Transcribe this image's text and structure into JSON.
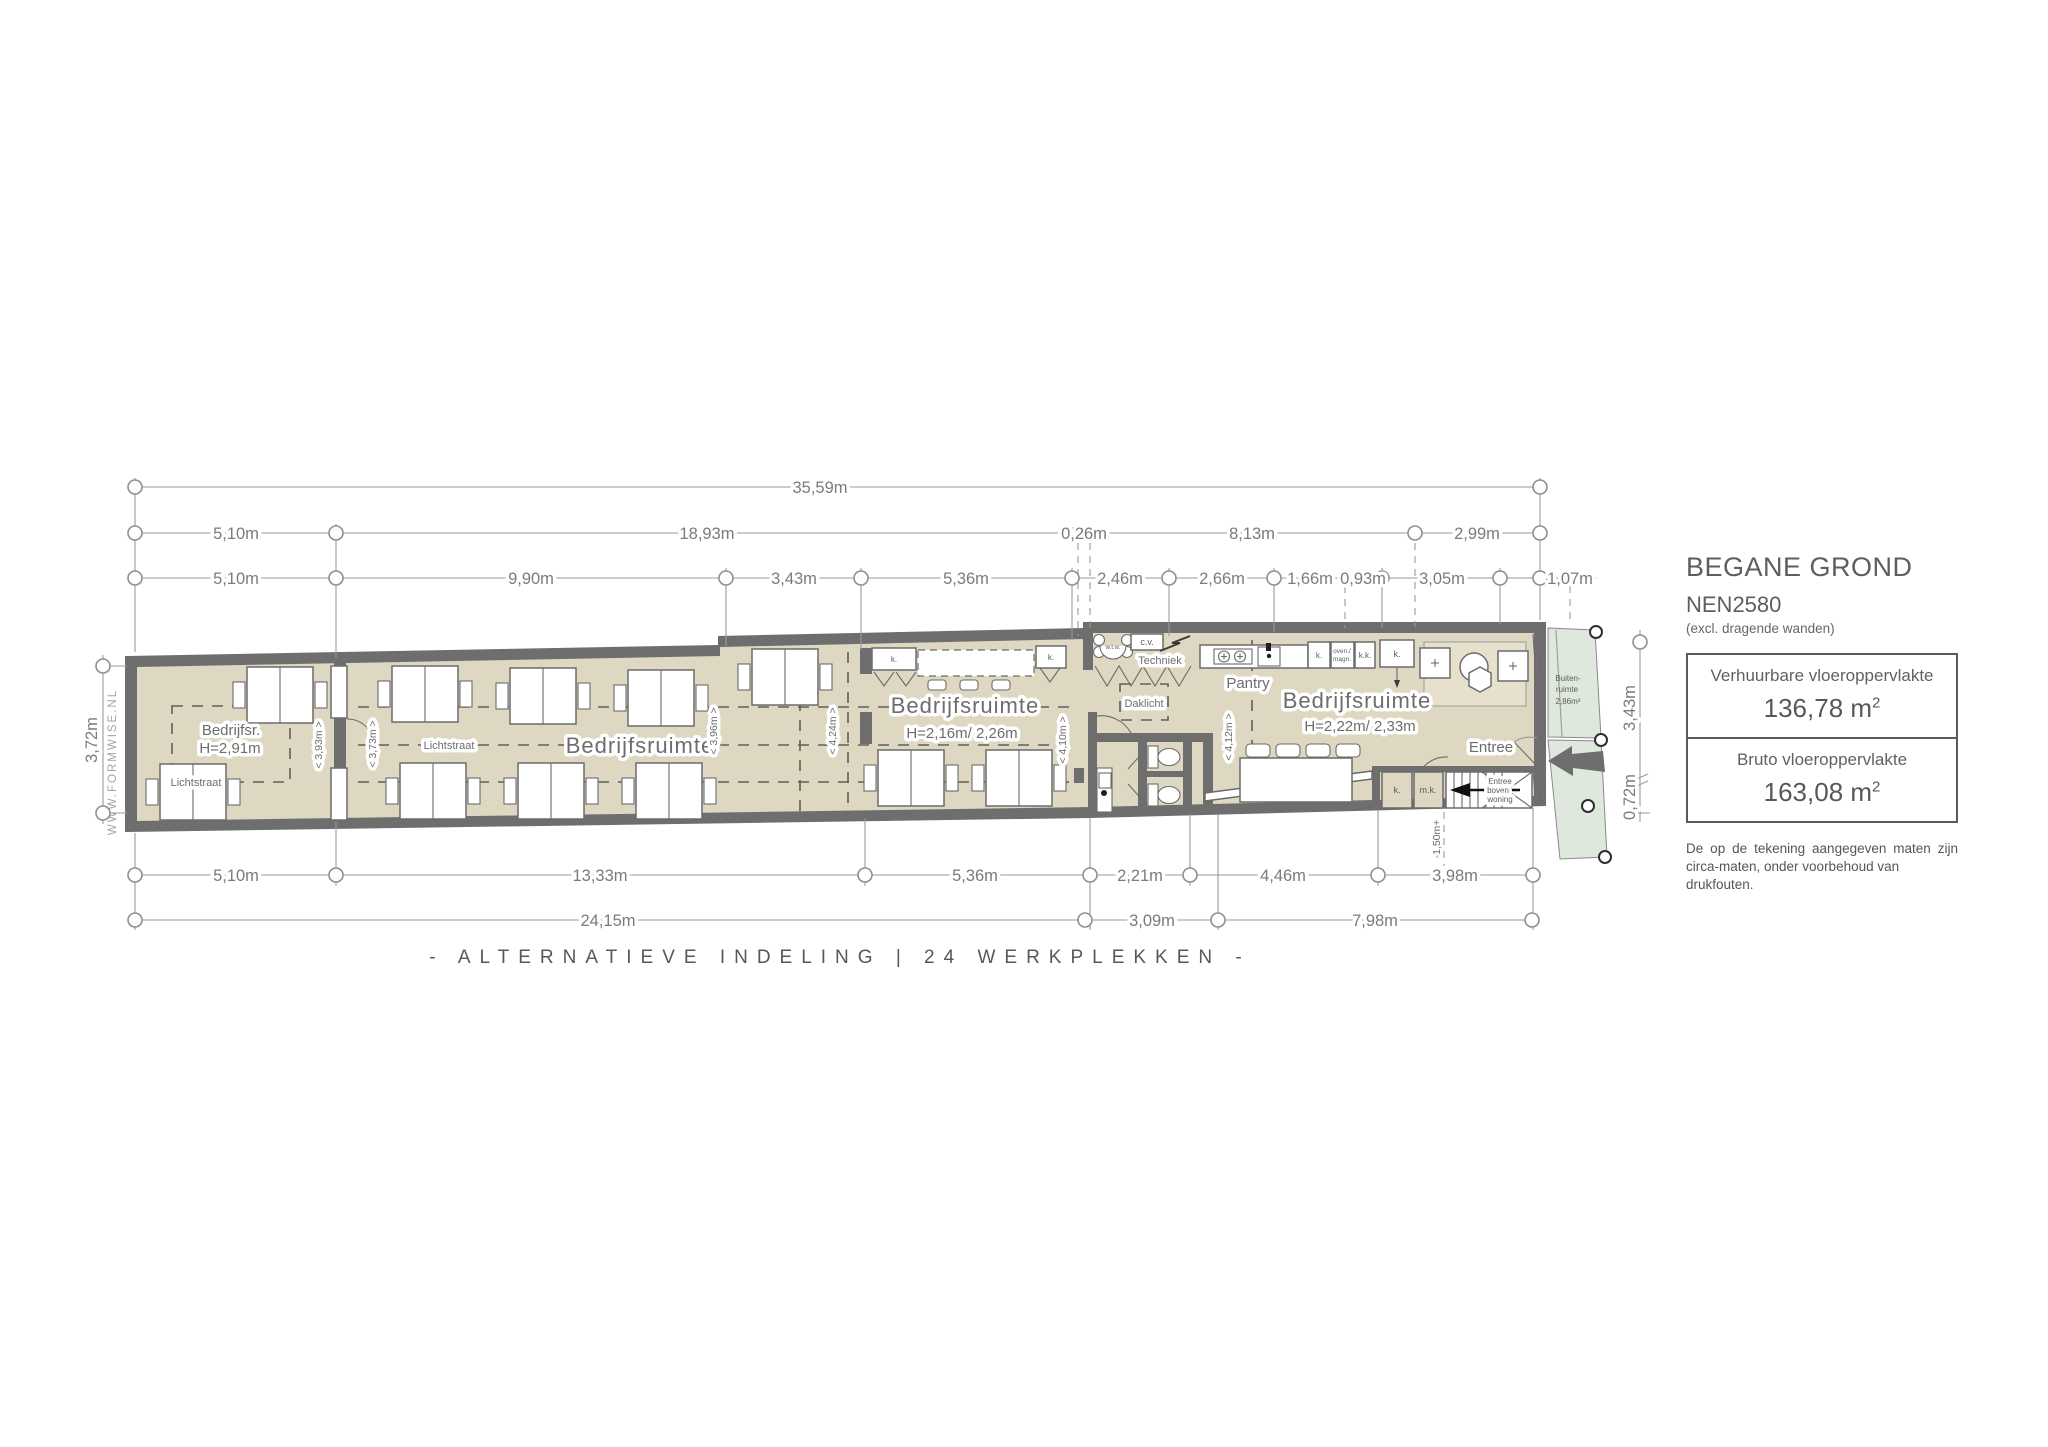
{
  "colors": {
    "wall": "#6e6e6e",
    "floor": "#ded8c2",
    "outdoor": "#dfe8dc",
    "dim_line": "#9a9a9a",
    "text": "#6b6b6b"
  },
  "dims": {
    "t1": [
      "35,59m"
    ],
    "t2": [
      "5,10m",
      "18,93m",
      "0,26m",
      "8,13m",
      "2,99m"
    ],
    "t3": [
      "5,10m",
      "9,90m",
      "3,43m",
      "5,36m",
      "2,46m",
      "2,66m",
      "1,66m",
      "0,93m",
      "3,05m",
      "1,07m"
    ],
    "b1": [
      "5,10m",
      "13,33m",
      "5,36m",
      "2,21m",
      "4,46m",
      "3,98m"
    ],
    "b2": [
      "24,15m",
      "3,09m",
      "7,98m"
    ],
    "left": "3,72m",
    "right_upper": "3,43m",
    "right_lower": "0,72m",
    "stair": "-1,50m+"
  },
  "rooms": {
    "left_name": "Bedrijfsr.",
    "left_height": "H=2,91m",
    "main_name": "Bedrijfsruimte",
    "mid_name": "Bedrijfsruimte",
    "mid_height": "H=2,16m/ 2,26m",
    "right_name": "Bedrijfsruimte",
    "right_height": "H=2,22m/ 2,33m",
    "pantry": "Pantry",
    "techniek": "Techniek",
    "daklicht": "Daklicht",
    "entree": "Entree",
    "lichtstraat": "Lichtstraat",
    "buiten_line1": "Buiten-",
    "buiten_line2": "ruimte",
    "buiten_line3": "2,86m²",
    "stair_line1": "Entree",
    "stair_line2": "boven",
    "stair_line3": "woning"
  },
  "fixtures": {
    "k": "k.",
    "kk": "k.k.",
    "mk": "m.k.",
    "cv": "c.v.",
    "wtw": "w.t.w.",
    "oven_line1": "oven./",
    "oven_line2": "magn."
  },
  "inner_dims": {
    "d393": "< 3,93m >",
    "d373": "< 3,73m >",
    "d396": "< 3,96m >",
    "d424": "< 4,24m >",
    "d410": "< 4,10m >",
    "d412": "< 4,12m >"
  },
  "watermark": "WWW.FORMWISE.NL",
  "legend": {
    "title": "BEGANE GROND",
    "subtitle": "NEN2580",
    "note": "(excl. dragende wanden)",
    "area1_label": "Verhuurbare vloeroppervlakte",
    "area1_value": "136,78 m",
    "area1_sup": "2",
    "area2_label": "Bruto vloeroppervlakte",
    "area2_value": "163,08 m",
    "area2_sup": "2",
    "disclaimer_line1": "De op de tekening aangegeven maten zijn",
    "disclaimer_line2": "circa-maten, onder voorbehoud van drukfouten."
  },
  "footer": {
    "caption": "- ALTERNATIEVE INDELING | 24 WERKPLEKKEN -"
  }
}
